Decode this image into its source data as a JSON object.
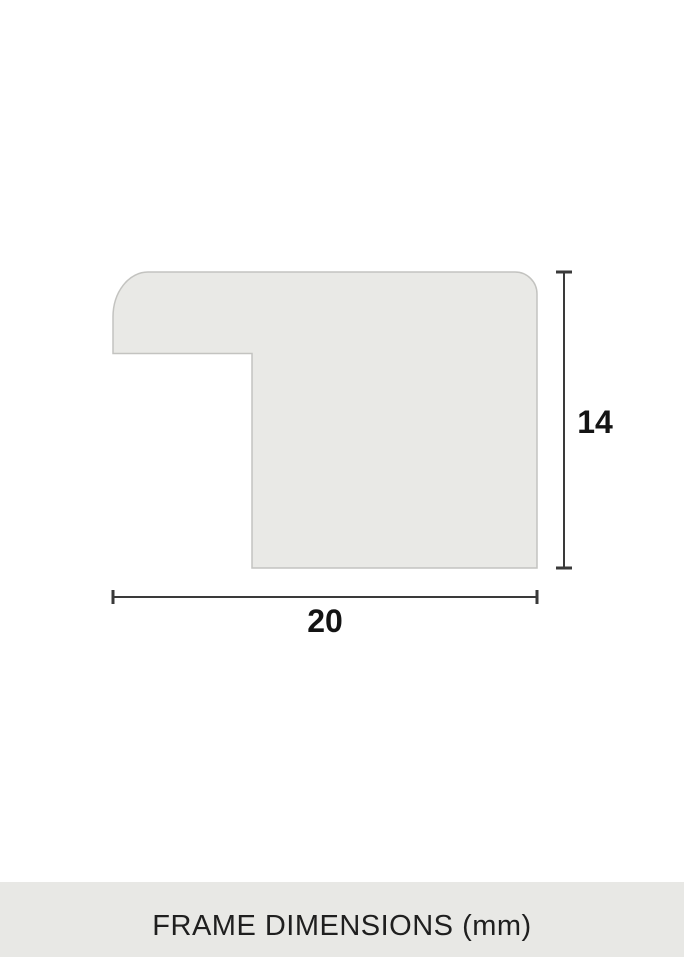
{
  "diagram": {
    "width_value": "20",
    "height_value": "14",
    "shape_fill": "#e9e9e6",
    "shape_stroke": "#c3c3c0",
    "dimension_line_color": "#3a3a3a",
    "label_color": "#141414"
  },
  "footer": {
    "label": "FRAME DIMENSIONS (mm)",
    "background": "#e8e8e5",
    "text_color": "#1f1f1f"
  }
}
